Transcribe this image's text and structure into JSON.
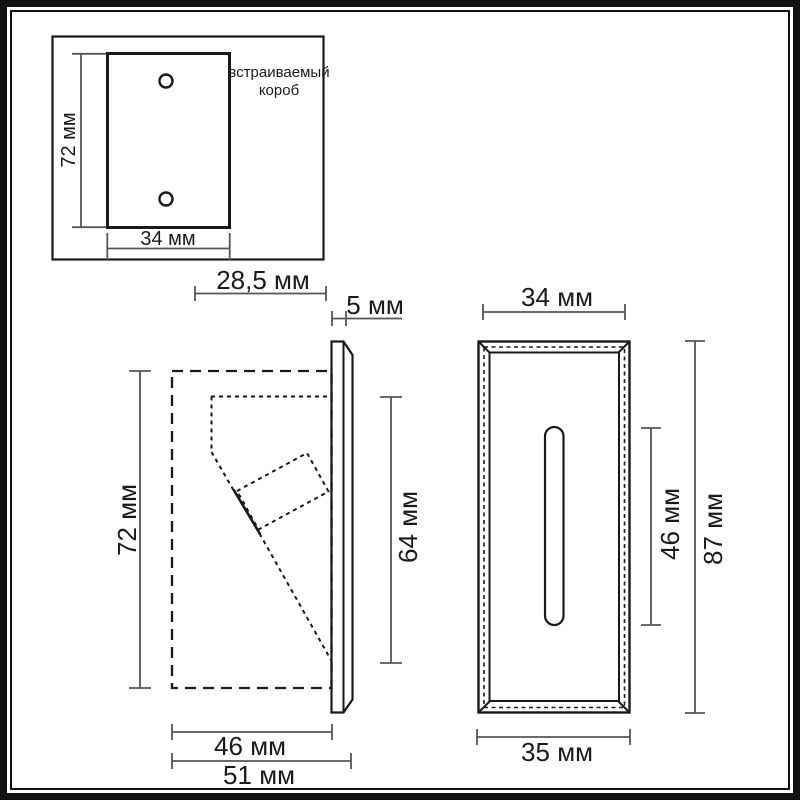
{
  "meta": {
    "kind": "technical-drawing",
    "units": "мм",
    "colors": {
      "line": "#1a1a1a",
      "dim_line": "#555555",
      "background": "#ffffff",
      "frame": "#111111"
    }
  },
  "inset": {
    "label_line1": "встраиваемый",
    "label_line2": "короб",
    "height": "72 мм",
    "width": "34 мм"
  },
  "side": {
    "recess_depth": "28,5 мм",
    "plate_thickness": "5 мм",
    "height": "72 мм",
    "inner_height": "64 мм",
    "body_depth": "46 мм",
    "total_depth": "51 мм"
  },
  "front": {
    "width": "34 мм",
    "slot_height": "46 мм",
    "height": "87 мм",
    "bottom_width": "35 мм"
  },
  "chart_data": {
    "type": "table",
    "title": "Светильник — габаритные размеры",
    "views": [
      {
        "name": "встраиваемый короб",
        "dimensions": [
          {
            "axis": "height",
            "value_mm": 72
          },
          {
            "axis": "width",
            "value_mm": 34
          }
        ]
      },
      {
        "name": "вид сбоку",
        "dimensions": [
          {
            "axis": "recess_depth",
            "value_mm": 28.5
          },
          {
            "axis": "plate_thickness",
            "value_mm": 5
          },
          {
            "axis": "height",
            "value_mm": 72
          },
          {
            "axis": "inner_height",
            "value_mm": 64
          },
          {
            "axis": "body_depth",
            "value_mm": 46
          },
          {
            "axis": "total_depth",
            "value_mm": 51
          }
        ]
      },
      {
        "name": "вид спереди",
        "dimensions": [
          {
            "axis": "width",
            "value_mm": 34
          },
          {
            "axis": "slot_height",
            "value_mm": 46
          },
          {
            "axis": "height",
            "value_mm": 87
          },
          {
            "axis": "bottom_width",
            "value_mm": 35
          }
        ]
      }
    ]
  }
}
